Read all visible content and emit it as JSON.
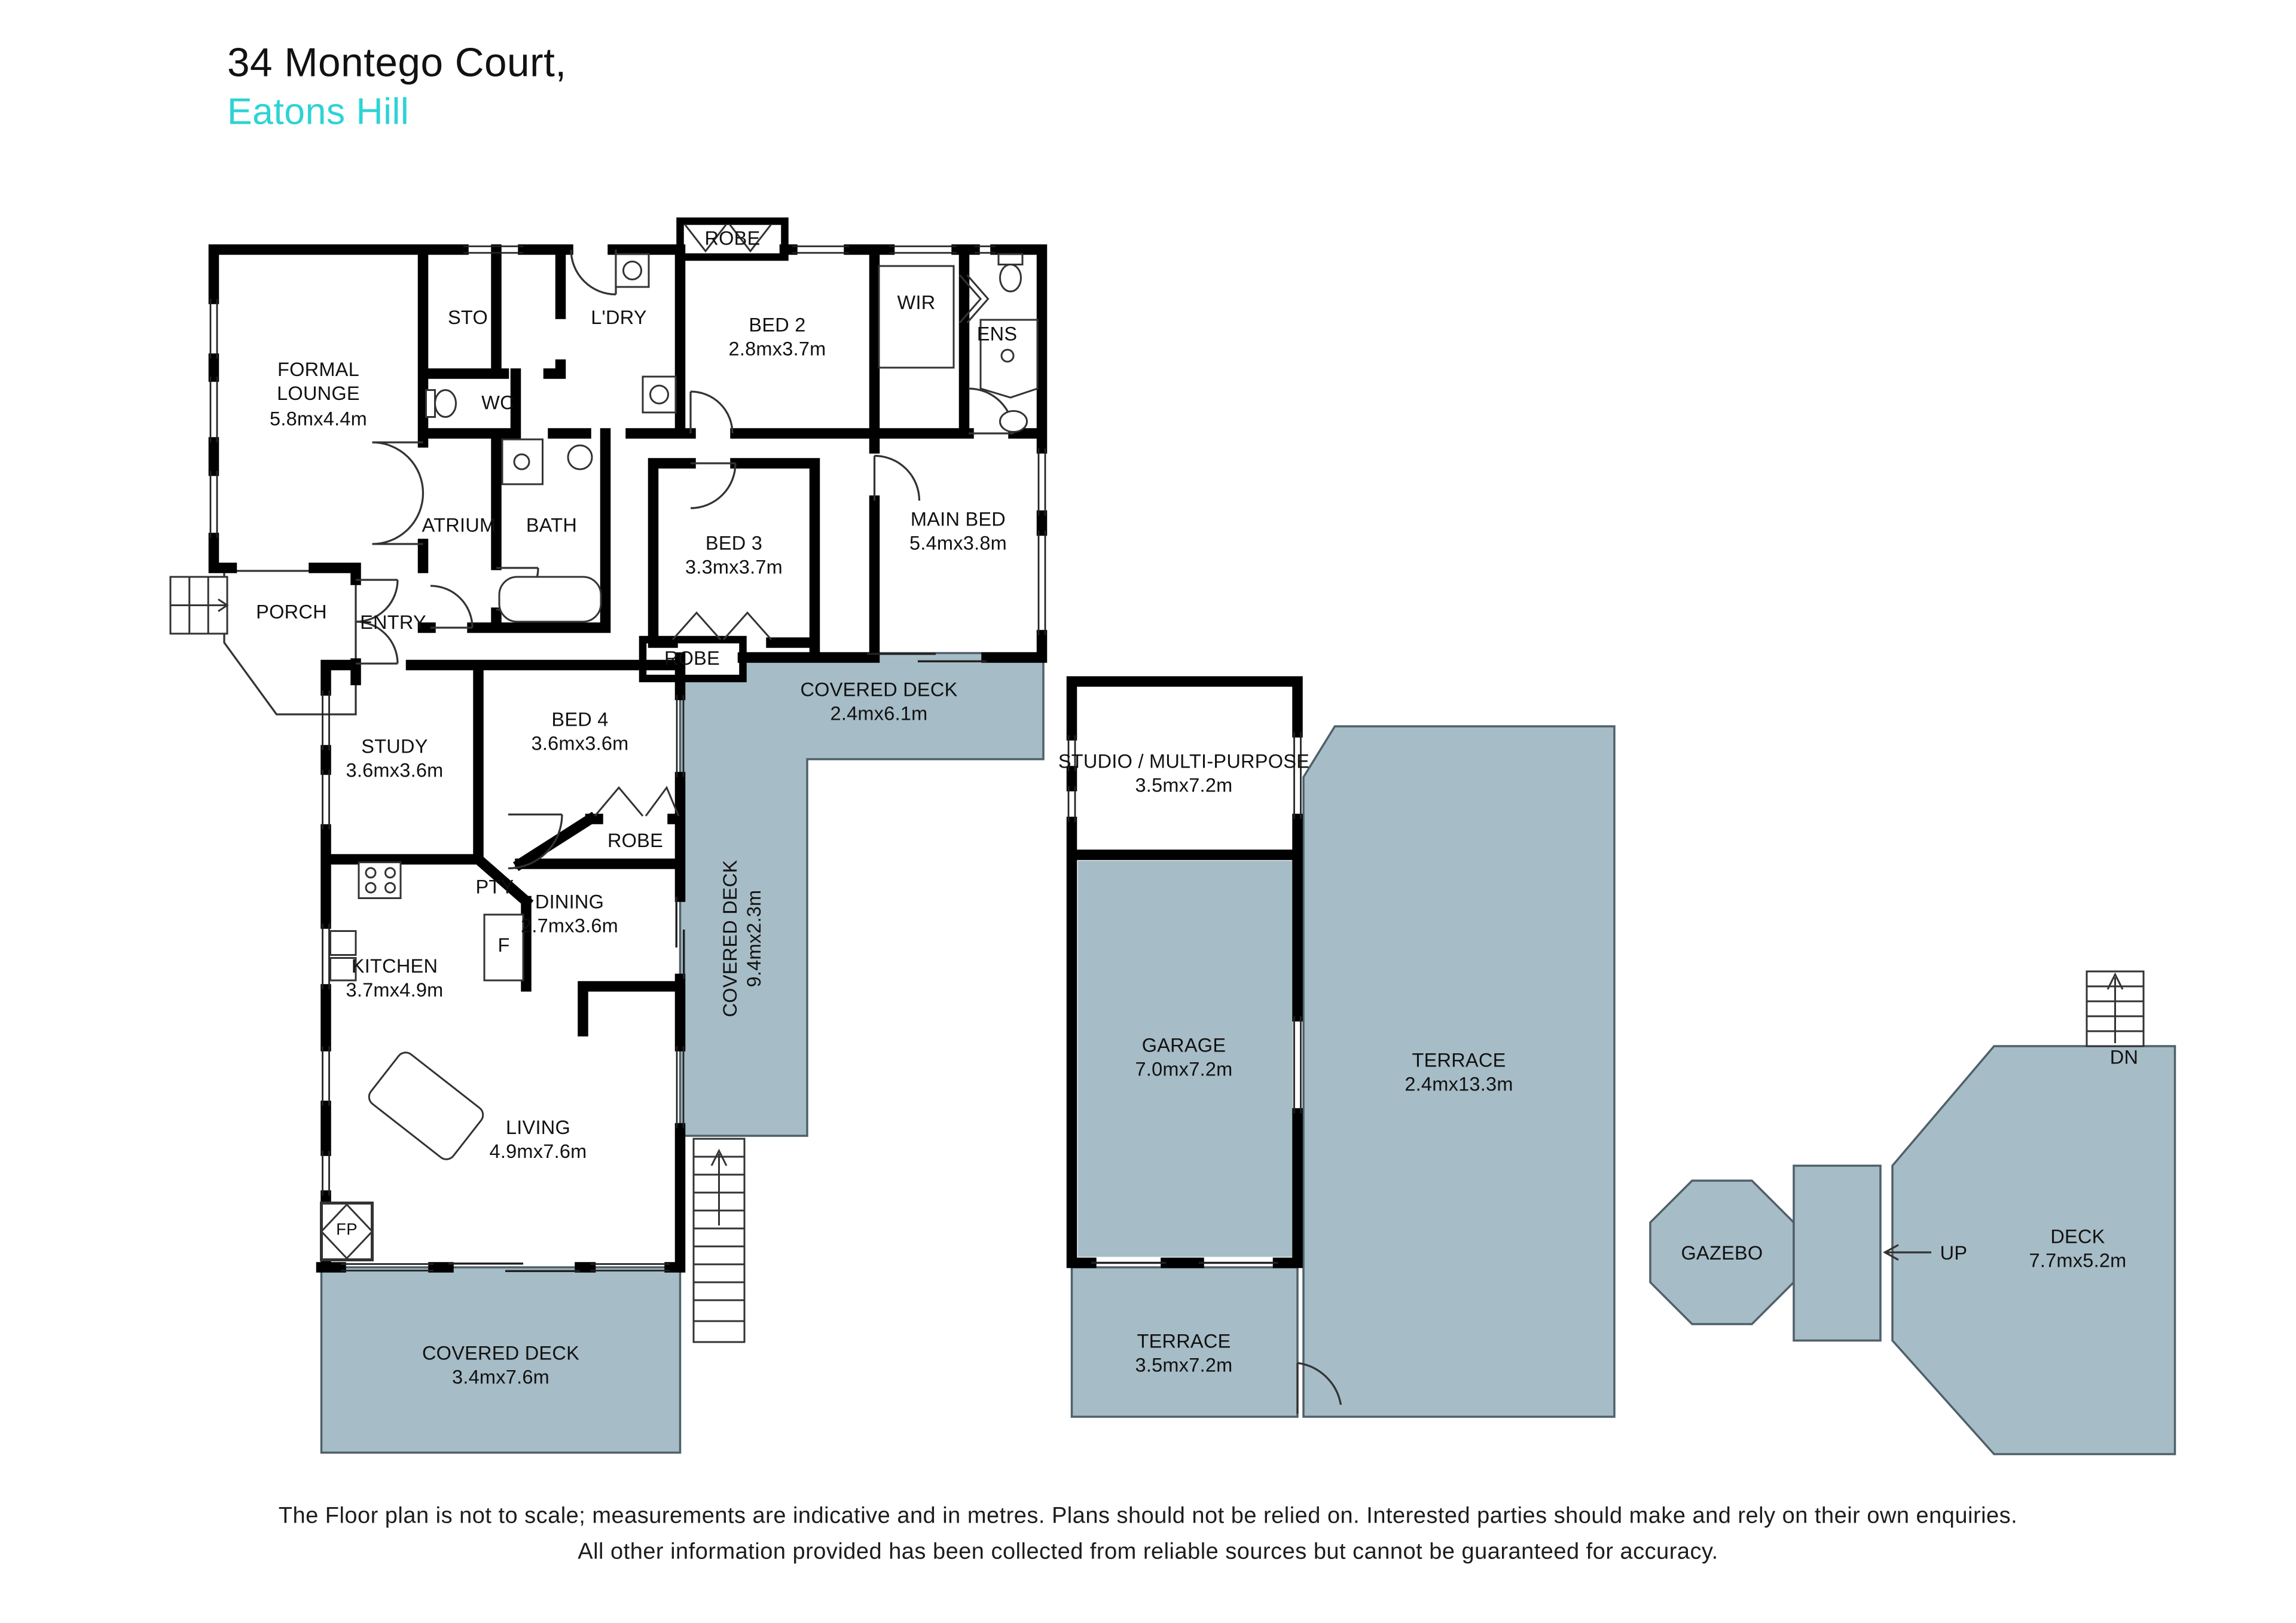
{
  "title": {
    "address": "34 Montego Court,",
    "suburb": "Eatons Hill"
  },
  "labels": {
    "formal_lounge": "FORMAL\nLOUNGE\n5.8mx4.4m",
    "sto": "STO",
    "ldry": "L'DRY",
    "wc": "WC",
    "atrium": "ATRIUM",
    "bath": "BATH",
    "bed2": "BED 2\n2.8mx3.7m",
    "robe_bed2": "ROBE",
    "wir": "WIR",
    "ens": "ENS",
    "bed3": "BED 3\n3.3mx3.7m",
    "main_bed": "MAIN BED\n5.4mx3.8m",
    "robe_bed3": "ROBE",
    "porch": "PORCH",
    "entry": "ENTRY",
    "covered_deck_top": "COVERED DECK\n2.4mx6.1m",
    "covered_deck_side": "COVERED DECK\n9.4mx2.3m",
    "study": "STUDY\n3.6mx3.6m",
    "bed4": "BED 4\n3.6mx3.6m",
    "robe_bed4": "ROBE",
    "pty": "PTY",
    "fridge": "F",
    "kitchen": "KITCHEN\n3.7mx4.9m",
    "dining": "DINING\n2.7mx3.6m",
    "living": "LIVING\n4.9mx7.6m",
    "fireplace": "FP",
    "covered_deck_bottom": "COVERED DECK\n3.4mx7.6m",
    "studio": "STUDIO / MULTI-PURPOSE\n3.5mx7.2m",
    "garage": "GARAGE\n7.0mx7.2m",
    "terrace_right": "TERRACE\n2.4mx13.3m",
    "terrace_bottom": "TERRACE\n3.5mx7.2m",
    "gazebo": "GAZEBO",
    "up": "UP",
    "deck": "DECK\n7.7mx5.2m",
    "dn": "DN"
  },
  "disclaimer": {
    "line1": "The Floor plan is not to scale; measurements are indicative and in metres. Plans should not be relied on. Interested parties should make and rely on their own enquiries.",
    "line2": "All other information provided has been collected from reliable sources but cannot be guaranteed for accuracy."
  },
  "colors": {
    "deck_fill": "#a6bcc6",
    "deck_stroke": "#4f6068",
    "wall": "#000000",
    "accent": "#2cd3d6",
    "text": "#111111"
  }
}
